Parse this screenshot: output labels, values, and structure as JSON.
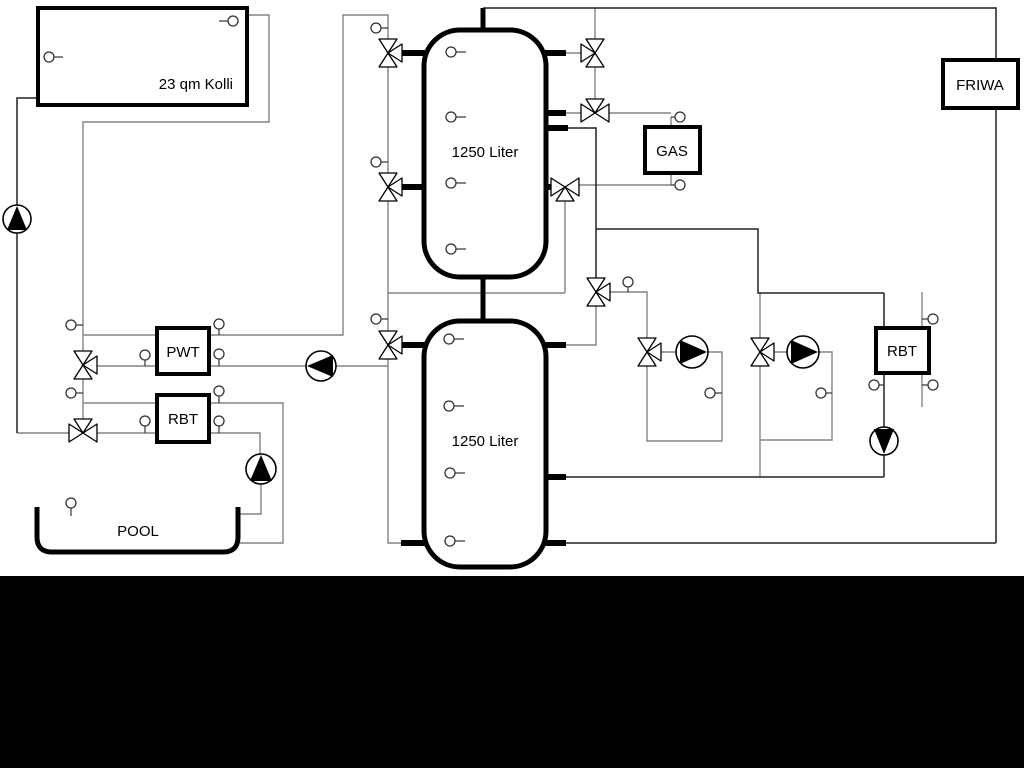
{
  "labels": {
    "collector": "23 qm Kolli",
    "tank_upper": "1250 Liter",
    "tank_lower": "1250 Liter",
    "pwt": "PWT",
    "rbt_left": "RBT",
    "rbt_right": "RBT",
    "gas": "GAS",
    "friwa": "FRIWA",
    "pool": "POOL"
  },
  "colors": {
    "background": "#ffffff",
    "pipe_gray": "#848484",
    "pipe_dark": "#222222",
    "component_black": "#000000",
    "letterbox_band": "#000000"
  }
}
